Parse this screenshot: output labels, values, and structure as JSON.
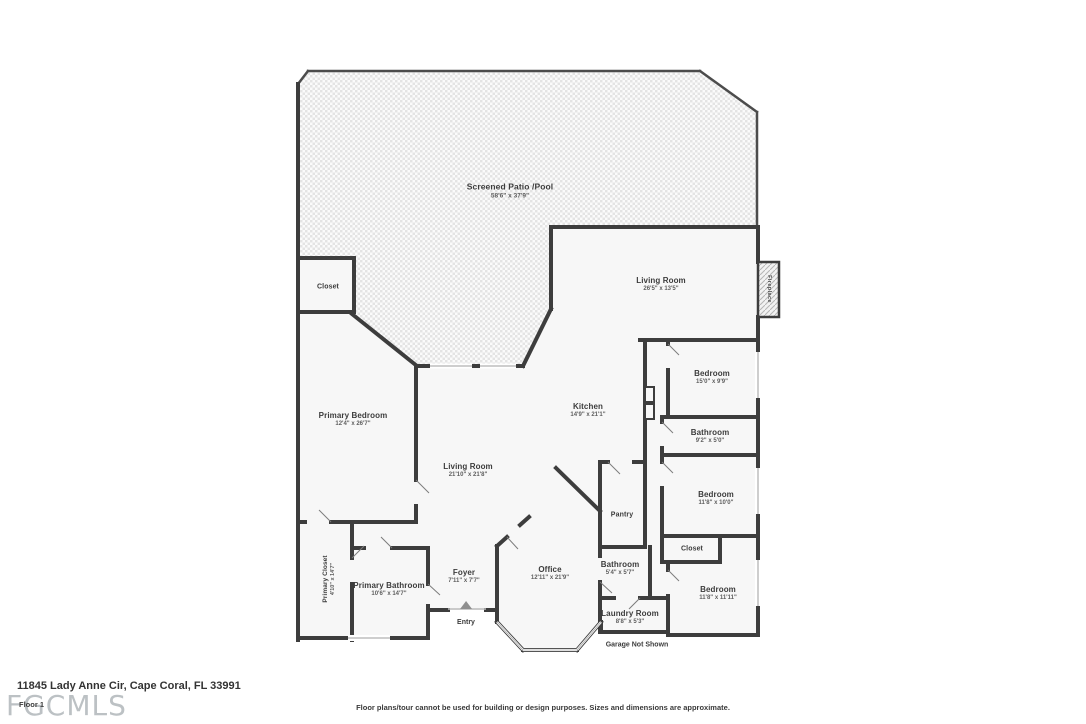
{
  "meta": {
    "address": "11845 Lady Anne Cir, Cape Coral, FL 33991",
    "floor_label": "Floor 1",
    "watermark": "FGCMLS",
    "disclaimer": "Floor plans/tour cannot be used for building or design purposes. Sizes and dimensions are approximate.",
    "garage_note": "Garage Not Shown",
    "entry_label": "Entry"
  },
  "colors": {
    "wall": "#3d3d3d",
    "room_fill": "#f7f7f7",
    "patio_check": "#e4e4e4",
    "label_text": "#3c3c3c",
    "dims_text": "#5e5e5e",
    "watermark_gray": "#bcc1c4"
  },
  "rooms": [
    {
      "name": "Screened Patio /Pool",
      "dims": "58'6\" x 37'9\""
    },
    {
      "name": "Living Room",
      "dims": "26'5\" x 13'5\""
    },
    {
      "name": "Fireplace"
    },
    {
      "name": "Closet"
    },
    {
      "name": "Primary Bedroom",
      "dims": "12'4\" x 26'7\""
    },
    {
      "name": "Kitchen",
      "dims": "14'9\" x 21'1\""
    },
    {
      "name": "Bedroom",
      "dims": "15'0\" x 9'9\""
    },
    {
      "name": "Bathroom",
      "dims": "9'2\" x 5'0\""
    },
    {
      "name": "Living Room",
      "dims": "21'10\" x 21'8\""
    },
    {
      "name": "Bedroom",
      "dims": "11'8\" x 10'0\""
    },
    {
      "name": "Pantry"
    },
    {
      "name": "Closet"
    },
    {
      "name": "Primary Closet",
      "dims": "4'10\" x 14'7\""
    },
    {
      "name": "Primary Bathroom",
      "dims": "10'6\" x 14'7\""
    },
    {
      "name": "Foyer",
      "dims": "7'11\" x 7'7\""
    },
    {
      "name": "Office",
      "dims": "12'11\" x 21'9\""
    },
    {
      "name": "Bathroom",
      "dims": "5'4\" x 5'7\""
    },
    {
      "name": "Laundry Room",
      "dims": "8'8\" x 5'3\""
    },
    {
      "name": "Bedroom",
      "dims": "11'8\" x 11'11\""
    }
  ]
}
